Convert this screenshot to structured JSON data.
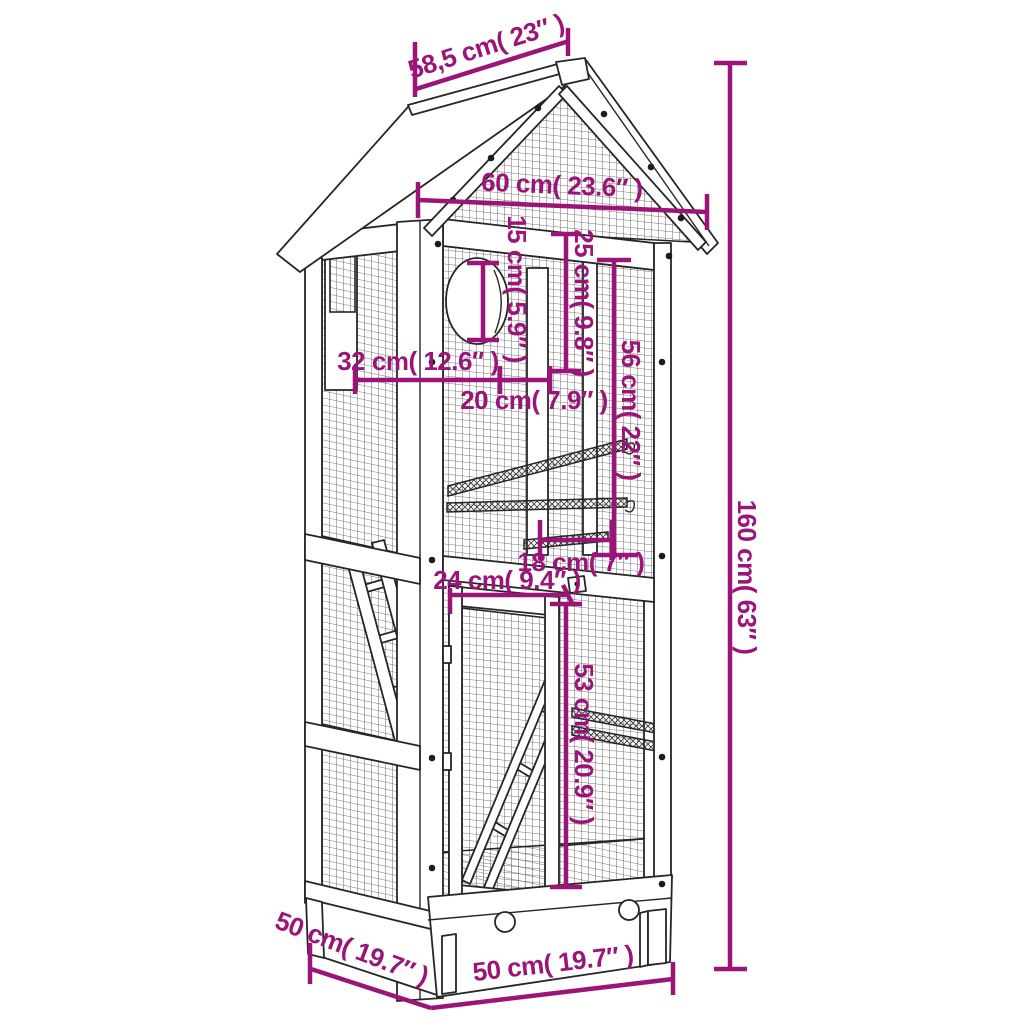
{
  "figure": {
    "subject": "wooden aviary bird cage line drawing with dimension callouts",
    "colors": {
      "accent": "#9B1578",
      "line": "#262626",
      "mesh": "#4d4d4d"
    },
    "dims": {
      "roof_depth": "58,5 cm( 23″ )",
      "roof_width": "60 cm( 23.6″ )",
      "hole_diameter": "15 cm( 5.9″ )",
      "nest_height": "25 cm( 9.8″ )",
      "upper_height": "56 cm( 22″ )",
      "hole_offset": "32 cm( 12.6″ )",
      "hole_gap": "20 cm( 7.9″ )",
      "perch_length": "18 cm( 7″ )",
      "door_width": "24 cm( 9.4″ )",
      "door_height": "53 cm( 20.9″ )",
      "total_height": "160 cm( 63″ )",
      "base_depth": "50 cm( 19.7″ )",
      "base_width": "50 cm( 19.7″ )"
    }
  }
}
